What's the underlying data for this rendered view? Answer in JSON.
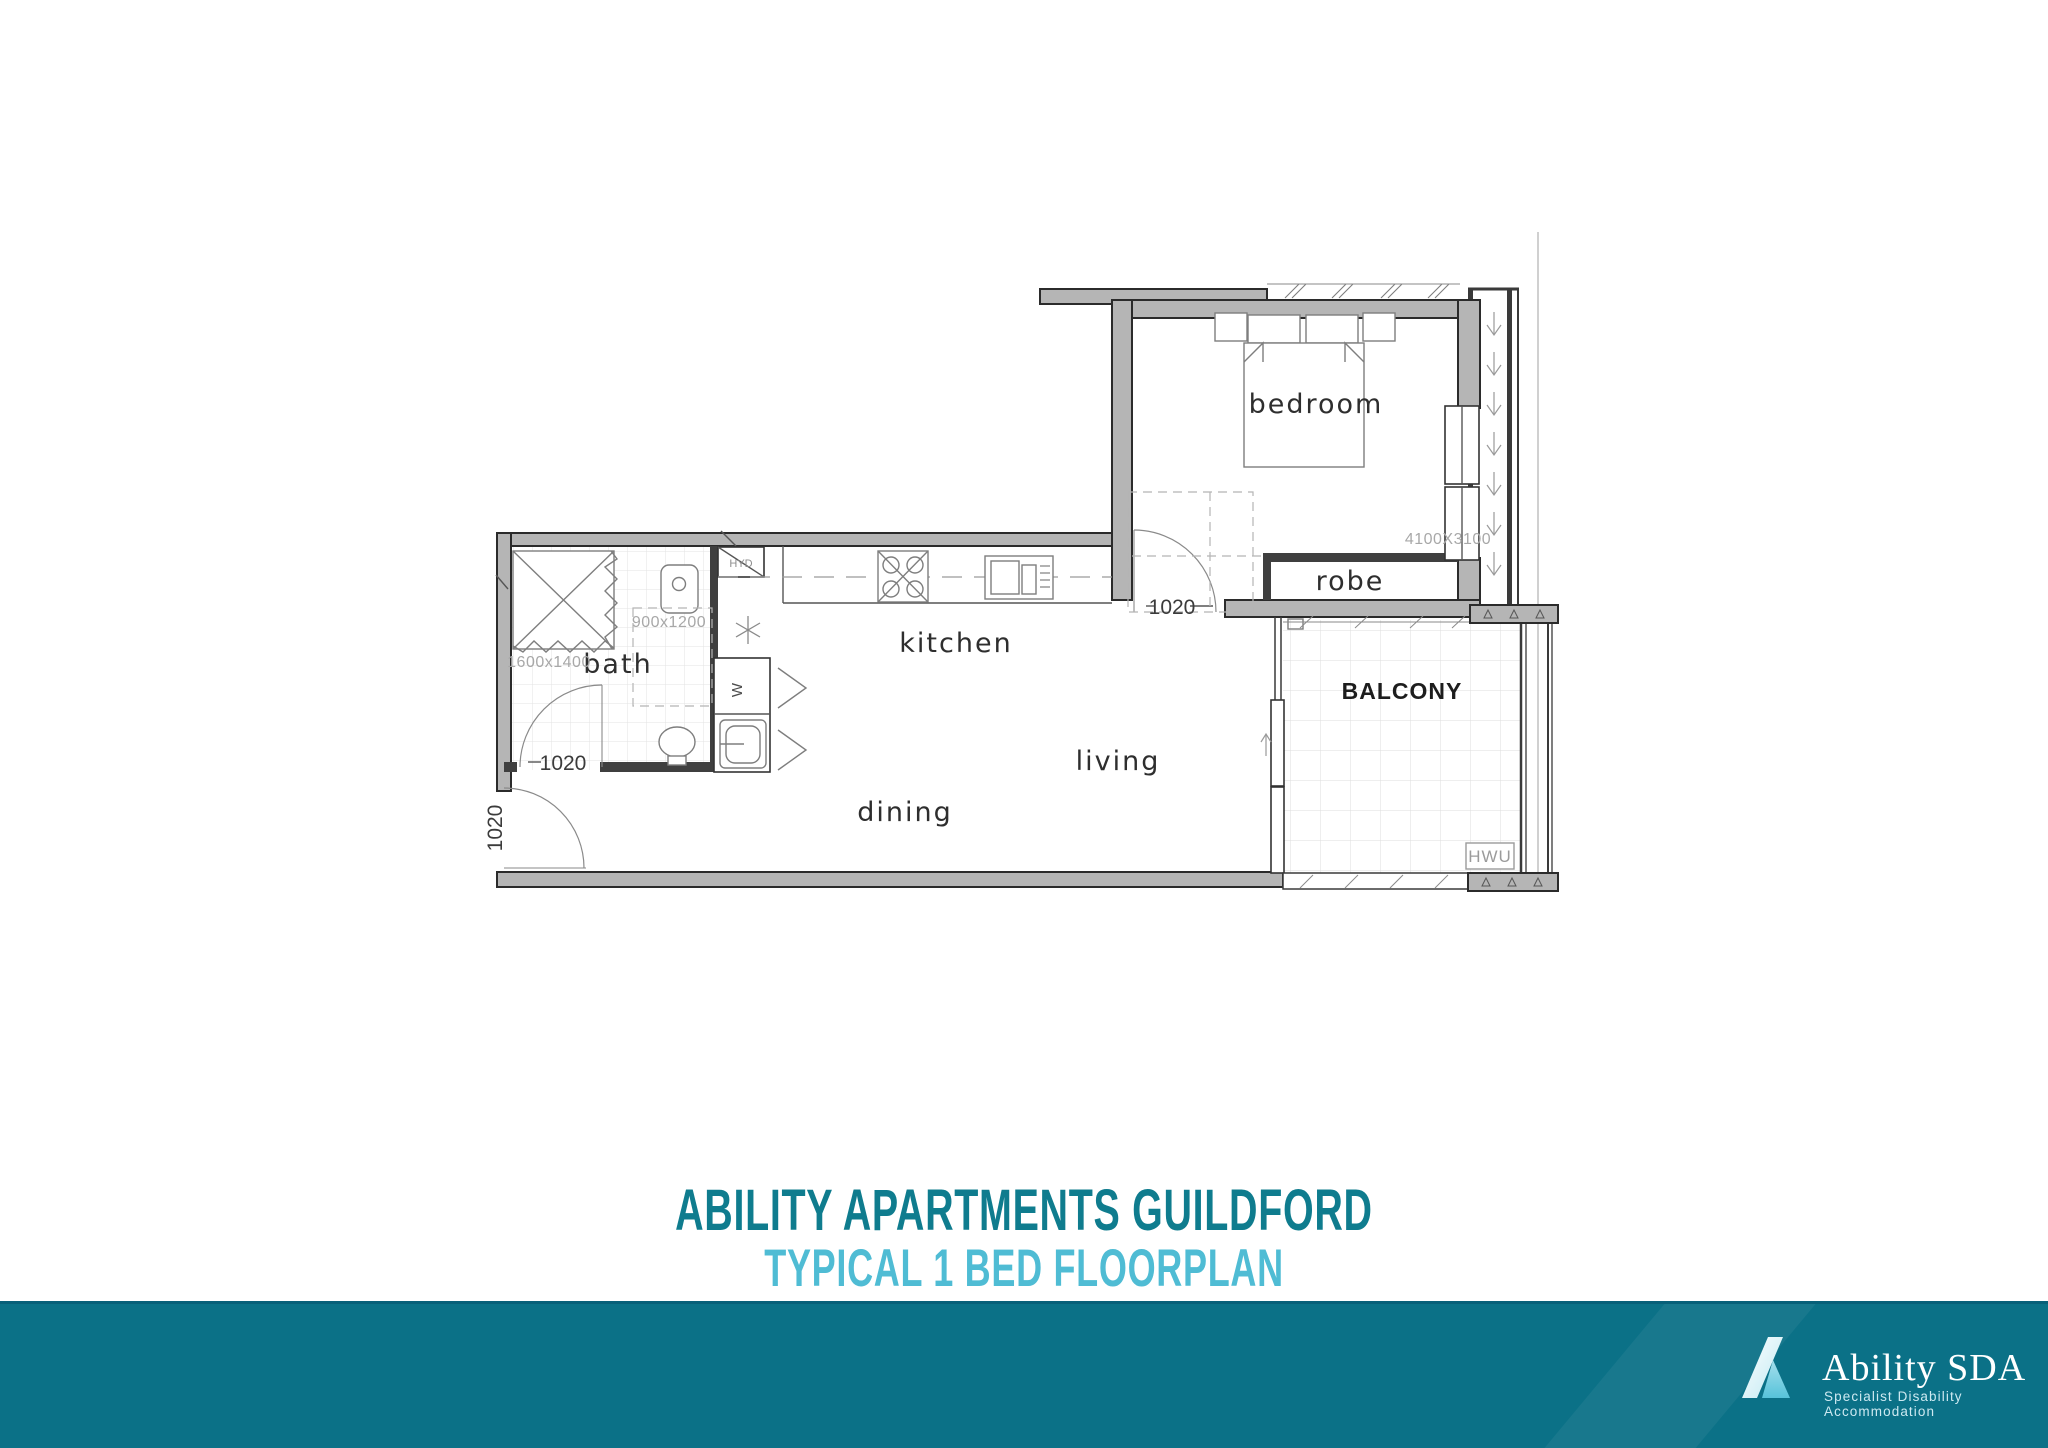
{
  "floorplan": {
    "rooms": {
      "bedroom": "bedroom",
      "robe": "robe",
      "kitchen": "kitchen",
      "living": "living",
      "dining": "dining",
      "bath": "bath",
      "balcony": "BALCONY"
    },
    "labels": {
      "hyd": "HYD",
      "hwu": "HWU",
      "washer": "W"
    },
    "dimensions": {
      "bedroom_size": "4100X3100",
      "shower_size": "900x1200",
      "bath_clearance": "1600x1400",
      "door_entry": "1020",
      "door_bath": "1020",
      "door_bedroom": "1020"
    }
  },
  "title": {
    "line1": "ABILITY APARTMENTS GUILDFORD",
    "line2": "TYPICAL 1 BED FLOORPLAN"
  },
  "footer": {
    "brand": "Ability SDA",
    "tagline": "Specialist Disability Accommodation"
  },
  "colors": {
    "title_dark_teal": "#0F7C8E",
    "title_light_teal": "#4FBCD4",
    "footer_teal": "#0B7187"
  }
}
